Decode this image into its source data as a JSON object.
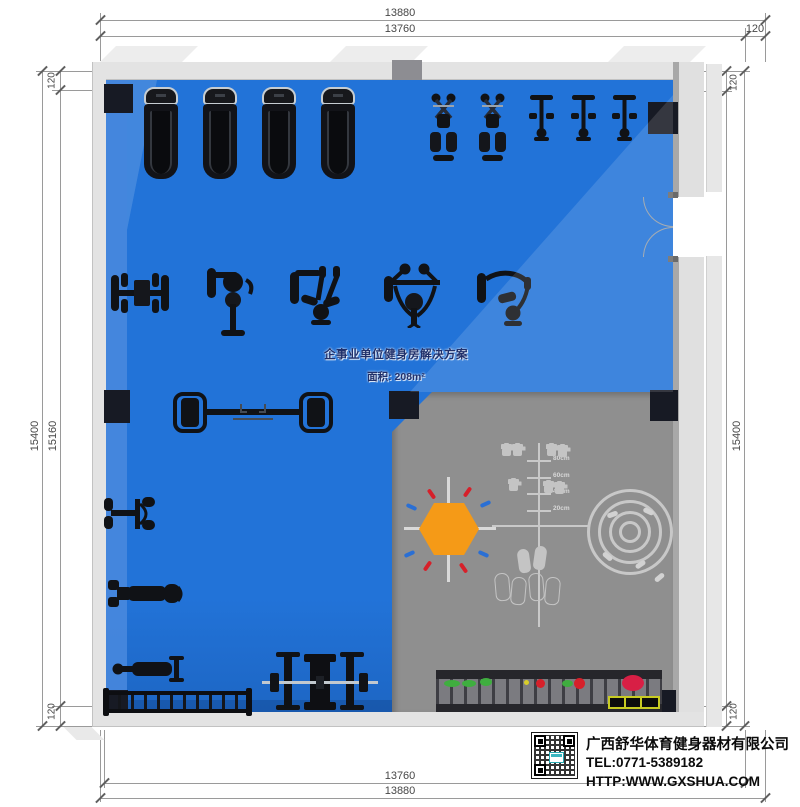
{
  "plan": {
    "title": "企事业单位健身房解决方案",
    "area": "面积: 208m²"
  },
  "dimensions": {
    "top_total": "13880",
    "top_clear": "13760",
    "top_wall": "120",
    "bottom_clear": "13760",
    "bottom_total": "13880",
    "left_total": "15400",
    "left_clear": "15160",
    "left_wall_top": "120",
    "left_wall_bottom": "120",
    "right_clear": "15160",
    "right_total": "15400",
    "right_wall_top": "120",
    "right_wall_bottom": "120"
  },
  "functional_zone": {
    "height_marks": [
      "80cm",
      "60cm",
      "40cm",
      "20cm"
    ]
  },
  "company": {
    "name": "广西舒华体育健身器材有限公司",
    "tel": "TEL:0771-5389182",
    "website": "HTTP:WWW.GXSHUA.COM"
  },
  "equipment": [
    {
      "name": "treadmill",
      "count": 4
    },
    {
      "name": "elliptical-trainer",
      "count": 2
    },
    {
      "name": "upright-bike",
      "count": 3
    },
    {
      "name": "strength-machine",
      "count": 5
    },
    {
      "name": "dual-half-rack",
      "count": 1
    },
    {
      "name": "pec-machine",
      "count": 1
    },
    {
      "name": "adjustable-bench",
      "count": 2
    },
    {
      "name": "dumbbell-rack",
      "count": 1
    },
    {
      "name": "bench-press-rack-with-barbell",
      "count": 1
    },
    {
      "name": "storage-rack-with-accessories",
      "count": 1
    },
    {
      "name": "agility-measure-grid",
      "count": 1
    },
    {
      "name": "hexagon-drill-marking",
      "count": 1
    },
    {
      "name": "target-circle-marking",
      "count": 1
    }
  ],
  "colors": {
    "floor": "#2273d8",
    "floor_light": "#4a8ade",
    "floor_dark": "#1d66c4",
    "zone": "#8f8f8f",
    "wall": "#e3e3e3",
    "wall_edge": "#c2c2c2",
    "pillar": "#171a24",
    "equip": "#101216",
    "mark": "#c9c9c9",
    "orange": "#f59a17",
    "red": "#d6202a",
    "blue_dash": "#2a6fd4",
    "green": "#3fae3f",
    "yellow": "#d8ce2a",
    "navy": "#20306b",
    "dim_line": "#9a9a9a",
    "dim_text": "#474747"
  }
}
